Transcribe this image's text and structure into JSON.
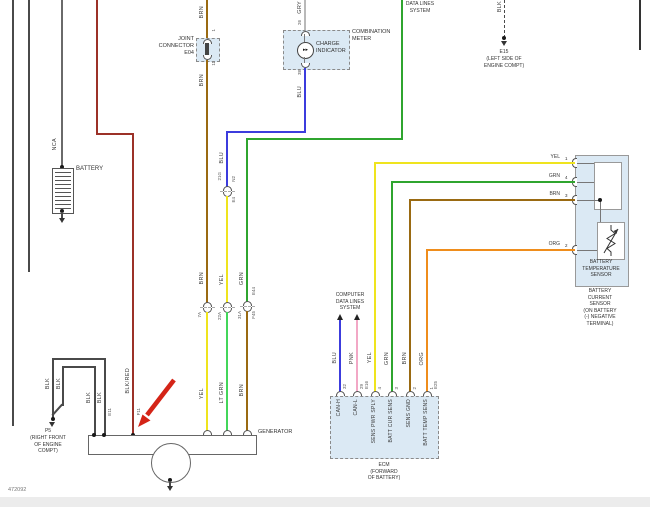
{
  "page": {
    "footer_id": "472092"
  },
  "colors": {
    "brn": "#9a6a12",
    "yel": "#efe41e",
    "grn": "#2fa52f",
    "lt_grn": "#43d65a",
    "blu": "#3c3cdd",
    "pnk": "#f2a8c6",
    "org": "#ef8d1c",
    "gry": "#b9b9b9",
    "blk": "#4a4a4a",
    "blk_red": "#9c3128",
    "annotation_red": "#d42417",
    "box_fill": "#dbe9f4"
  },
  "top_left": {
    "nca_label": "NCA",
    "battery_label": "BATTERY",
    "blk_red_label": "BLK/RED"
  },
  "joint_connector": {
    "line1": "JOINT",
    "line2": "CONNECTOR",
    "line3": "E04",
    "pin_top": "1",
    "pin_bottom": "11",
    "wire_above": "BRN",
    "wire_below": "BRN"
  },
  "combination_meter": {
    "name_line1": "COMBINATION",
    "name_line2": "METER",
    "indicator_line1": "CHARGE",
    "indicator_line2": "INDICATOR",
    "lamp_glyph": "▸▸",
    "wire_above": "GRY",
    "pin_top": "26",
    "pin_bottom": "38",
    "wire_below": "BLU"
  },
  "data_lines_top": {
    "line1": "DATA LINES",
    "line2": "SYSTEM"
  },
  "e15_ground": {
    "wire": "BLK",
    "name": "E15",
    "loc_line1": "(LEFT SIDE OF",
    "loc_line2": "ENGINE COMPT)"
  },
  "inline_connectors": {
    "c1_pin": "7A",
    "c2_pin": "21G",
    "c2_code_top": "N2",
    "c2_code_bottom": "E4",
    "c3_pin": "22A",
    "c4_pin": "31A",
    "c4_code_top": "E44",
    "c4_code_bottom": "F45"
  },
  "center_wires": {
    "blu_mid": "BLU",
    "blu_low": "BLU",
    "yel_mid": "YEL",
    "grn_mid": "GRN",
    "brn_mid": "BRN",
    "yel_low": "YEL",
    "lt_grn_low": "LT GRN",
    "brn_low": "BRN"
  },
  "generator": {
    "label": "GENERATOR",
    "pin_blk": "E11",
    "pin_blk_red": "F11",
    "blk_labels": [
      "BLK",
      "BLK",
      "BLK",
      "BLK"
    ]
  },
  "p5_ground": {
    "name": "P5",
    "loc_line1": "(RIGHT FRONT",
    "loc_line2": "OF ENGINE",
    "loc_line3": "COMPT)"
  },
  "computer_data_lines": {
    "line1": "COMPUTER",
    "line2": "DATA LINES",
    "line3": "SYSTEM"
  },
  "ecm": {
    "name": "ECM",
    "loc_line1": "(FORWARD",
    "loc_line2": "OF BATTERY)",
    "pins": [
      {
        "wire": "BLU",
        "signal": "CAN-H",
        "pin": "32",
        "code": ""
      },
      {
        "wire": "PNK",
        "signal": "CAN-L",
        "pin": "29",
        "code": "E16"
      },
      {
        "wire": "YEL",
        "signal": "SENS PWR SPLY",
        "pin": "4",
        "code": ""
      },
      {
        "wire": "GRN",
        "signal": "BATT CUR SENS",
        "pin": "3",
        "code": ""
      },
      {
        "wire": "BRN",
        "signal": "SENS GND",
        "pin": "2",
        "code": ""
      },
      {
        "wire": "ORG",
        "signal": "BATT TEMP SENS",
        "pin": "1",
        "code": "E25"
      }
    ]
  },
  "battery_current_sensor": {
    "name_lines": [
      "BATTERY",
      "CURRENT",
      "SENSOR",
      "(ON BATTERY",
      "(-) NEGATIVE",
      "TERMINAL)"
    ],
    "temp_sensor_lines": [
      "BATTERY",
      "TEMPERATURE",
      "SENSOR"
    ],
    "pins": [
      {
        "n": "1",
        "wire": "YEL"
      },
      {
        "n": "4",
        "wire": "GRN"
      },
      {
        "n": "3",
        "wire": "BRN"
      },
      {
        "n": "2",
        "wire": "ORG"
      }
    ]
  }
}
